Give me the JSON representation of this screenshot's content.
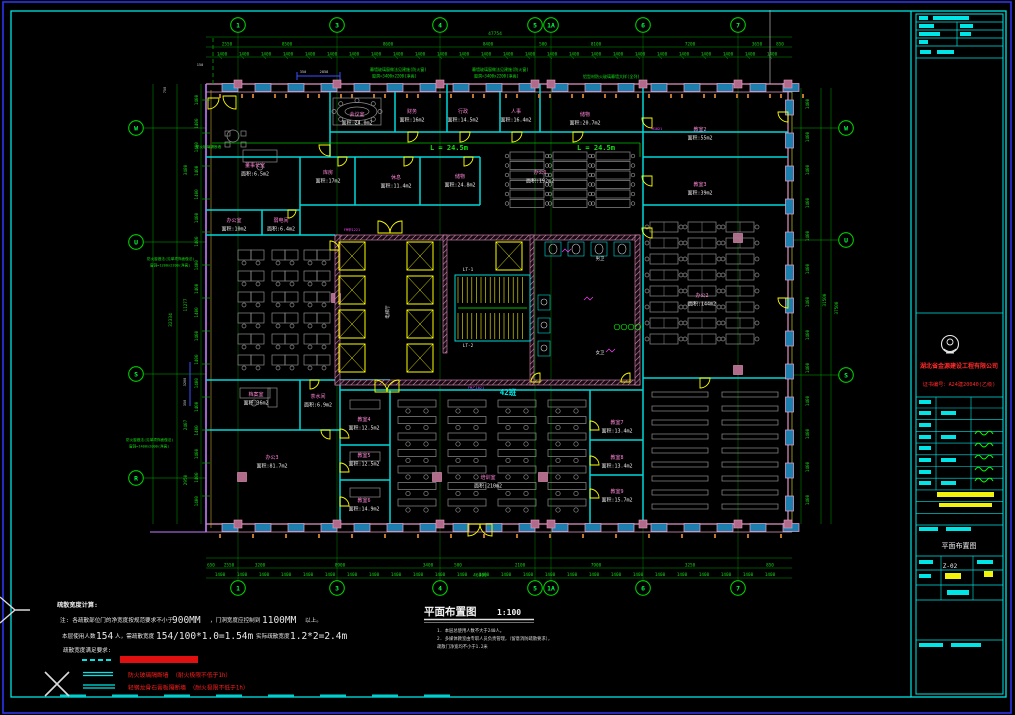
{
  "grid": {
    "top": [
      "1",
      "3",
      "4",
      "5",
      "1A",
      "6",
      "7"
    ],
    "bottom": [
      "1",
      "3",
      "4",
      "5",
      "1A",
      "6",
      "7"
    ],
    "left": [
      "W",
      "U",
      "S",
      "R"
    ],
    "right": [
      "W",
      "U",
      "S"
    ]
  },
  "dims": {
    "tick": "1400",
    "top_total": "47754",
    "top_segments": [
      "2550",
      "8500",
      "8600",
      "8400",
      "500",
      "8100",
      "7200",
      "3650",
      "850"
    ],
    "bottom_total": "46800",
    "bottom_segments": [
      "650",
      "2550",
      "3200",
      "8900",
      "3400",
      "500",
      "2100",
      "7900",
      "3250",
      "850"
    ],
    "left_segments": [
      "3480",
      "11277",
      "2407",
      "2950"
    ],
    "left_total": "32334",
    "right_segments": [
      "31500",
      "37500"
    ],
    "blue_top": [
      "350",
      "2858"
    ],
    "blue_left": [
      "3200",
      "350"
    ],
    "misc_150": "150",
    "misc_750": "750"
  },
  "annotations": {
    "curtain1a": "幕墙玻璃窗做法见建施(防火窗)",
    "curtain1b": "窗洞=3400x2200(净高)",
    "curtain2a": "幕墙玻璃窗做法见建施(防火窗)",
    "curtain2b": "窗洞=3400x2200(净高)",
    "curtain3": "铝型材防火玻璃幕墙大样(全列)",
    "left1a": "防火窗做法(见单项饰面做法)",
    "left1b": "窗洞=1200x2200(净高)",
    "left2a": "防火窗做法(见单项饰面做法)",
    "left2b": "窗洞=1400x2000(净高)",
    "corridor1": "L = 24.5m",
    "corridor2": "L = 24.5m",
    "firewall": "防火玻璃隔断墙",
    "train_count": "42班"
  },
  "core": {
    "hall": "电梯厅",
    "stair1": "LT-1",
    "stair2": "LT-2",
    "wc1": "男卫",
    "wc2": "女卫"
  },
  "rooms": [
    {
      "name": "会议室",
      "area": "面积:24.0m2"
    },
    {
      "name": "财务",
      "area": "面积:16m2"
    },
    {
      "name": "行政",
      "area": "面积:14.5m2"
    },
    {
      "name": "人事",
      "area": "面积:16.4m2"
    },
    {
      "name": "储物",
      "area": "面积:20.7m2"
    },
    {
      "name": "教室2",
      "area": "面积:55m2"
    },
    {
      "name": "教室3",
      "area": "面积:39m2"
    },
    {
      "name": "办公2",
      "area": "面积:144m2"
    },
    {
      "name": "董事长室",
      "area": "面积:6.5m2"
    },
    {
      "name": "库房",
      "area": "面积:17m2"
    },
    {
      "name": "休息",
      "area": "面积:11.4m2"
    },
    {
      "name": "储物",
      "area": "面积:24.8m2"
    },
    {
      "name": "办公1",
      "area": "面积:192m2"
    },
    {
      "name": "办公室",
      "area": "面积:10m2"
    },
    {
      "name": "弱电间",
      "area": "面积:6.4m2"
    },
    {
      "name": "档案室",
      "area": "面积:36m2"
    },
    {
      "name": "茶水间",
      "area": "面积:6.9m2"
    },
    {
      "name": "教室4",
      "area": "面积:12.5m2"
    },
    {
      "name": "教室5",
      "area": "面积:12.5m2"
    },
    {
      "name": "教室6",
      "area": "面积:14.9m2"
    },
    {
      "name": "办公3",
      "area": "面积:81.7m2"
    },
    {
      "name": "培训室",
      "area": "面积:210m2"
    },
    {
      "name": "教室7",
      "area": "面积:13.4m2"
    },
    {
      "name": "教室8",
      "area": "面积:13.4m2"
    },
    {
      "name": "教室9",
      "area": "面积:15.7m2"
    }
  ],
  "door_tags": [
    "FM甲1221",
    "FM乙1021",
    "M1021"
  ],
  "notes": {
    "title": "疏散宽度计算:",
    "l1a": "注: 各疏散部位门的净宽度按规范要求不小于",
    "l1b": "900MM",
    "l1c": "，门洞宽度应控制到",
    "l1d": "1100MM",
    "l1e": "以上。",
    "l2a": "本层使用人数",
    "l2b": "154",
    "l2c": "人，需疏散宽度",
    "l2d": "154/100*1.0=1.54m",
    "l2e": "实际疏散宽度",
    "l2f": "1.2*2=2.4m",
    "l3": "疏散宽度满足要求:"
  },
  "legend": {
    "item2": "防火玻璃隔断墙 （耐火极限不低于1h）",
    "item3": "轻钢龙骨石膏板隔断墙 （耐火极限不低于1h）"
  },
  "plan_title": {
    "label": "平面布置图",
    "scale": "1:100",
    "note1": "1. 本层总使用人数不大于240人。",
    "note2": "2. 多媒体教室由专职人员负责管理，（留意消防疏散要求），",
    "note3": "    疏散门净宽均不小于1.2米"
  },
  "titleblock": {
    "company": "湖北省金源建设工程有限公司",
    "cert": "证书编号：A24建20040(乙级)",
    "drawing_name": "平面布置图",
    "drawing_no": "Z-02"
  }
}
